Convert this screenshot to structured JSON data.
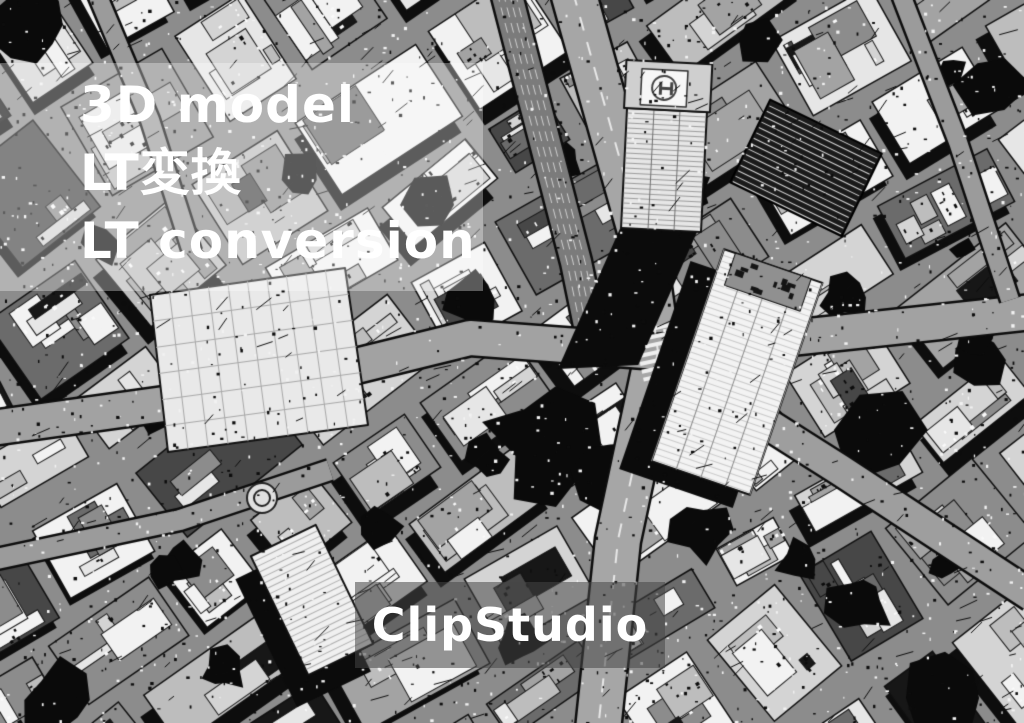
{
  "banner": {
    "title_lines": [
      "3D model",
      "LT変換",
      "LT conversion"
    ],
    "brand_label": "ClipStudio"
  },
  "colors": {
    "title_text": "#ffffff",
    "brand_text": "#ffffff",
    "title_panel_overlay": "rgba(255,255,255,0.33)",
    "brand_band_overlay": "rgba(70,70,70,0.55)",
    "art_white": "#f2f2f2",
    "art_road_gray": "#a2a2a2",
    "art_mid_gray": "#8c8c8c",
    "art_black": "#0d0d0d"
  }
}
